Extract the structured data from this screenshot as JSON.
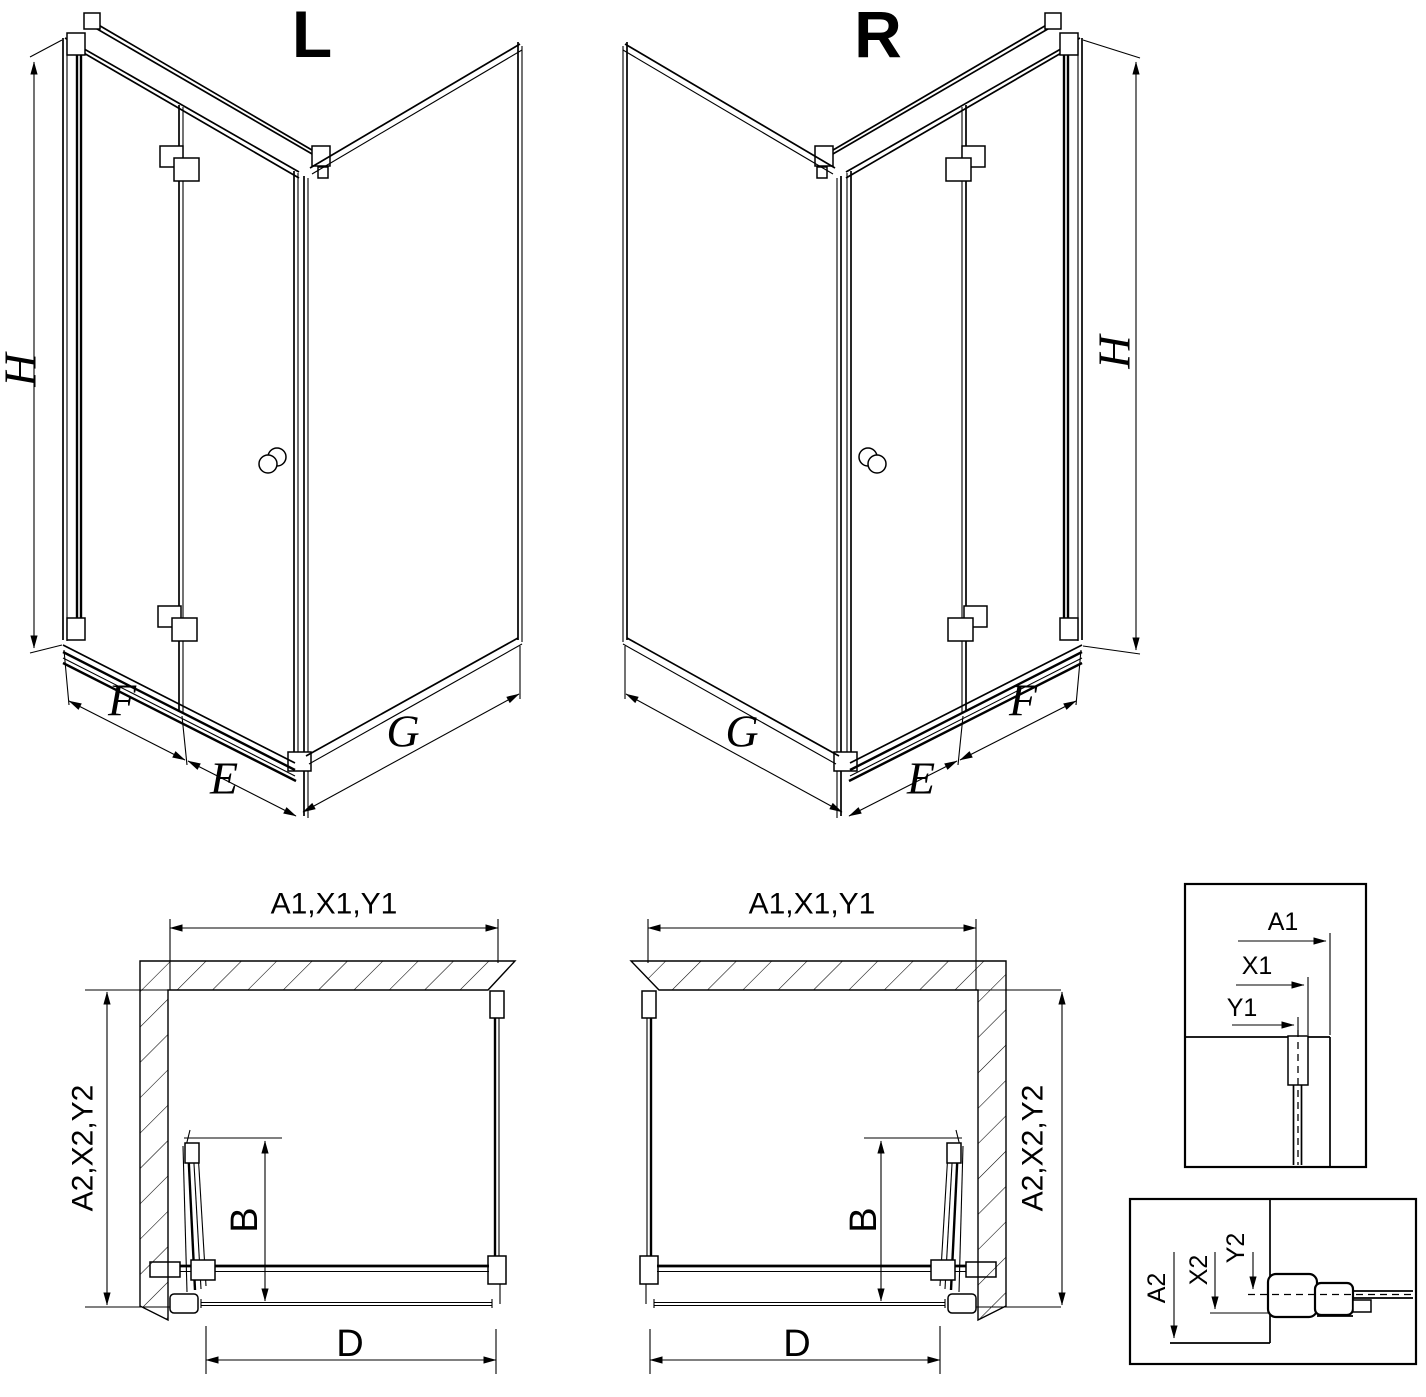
{
  "page": {
    "background": "#ffffff",
    "line_color": "#000000",
    "type": "shower-enclosure-technical-drawing"
  },
  "iso_left": {
    "title": "L",
    "height": "H",
    "panel_f": "F",
    "panel_e": "E",
    "panel_g": "G"
  },
  "iso_right": {
    "title": "R",
    "height": "H",
    "panel_f": "F",
    "panel_e": "E",
    "panel_g": "G"
  },
  "plan_left": {
    "top_dims": "A1,X1,Y1",
    "side_dims": "A2,X2,Y2",
    "door_projection": "B",
    "entry_width": "D"
  },
  "plan_right": {
    "top_dims": "A1,X1,Y1",
    "side_dims": "A2,X2,Y2",
    "door_projection": "B",
    "entry_width": "D"
  },
  "detail_horizontal": {
    "dim_a": "A1",
    "dim_x": "X1",
    "dim_y": "Y1"
  },
  "detail_vertical": {
    "dim_a": "A2",
    "dim_x": "X2",
    "dim_y": "Y2"
  }
}
